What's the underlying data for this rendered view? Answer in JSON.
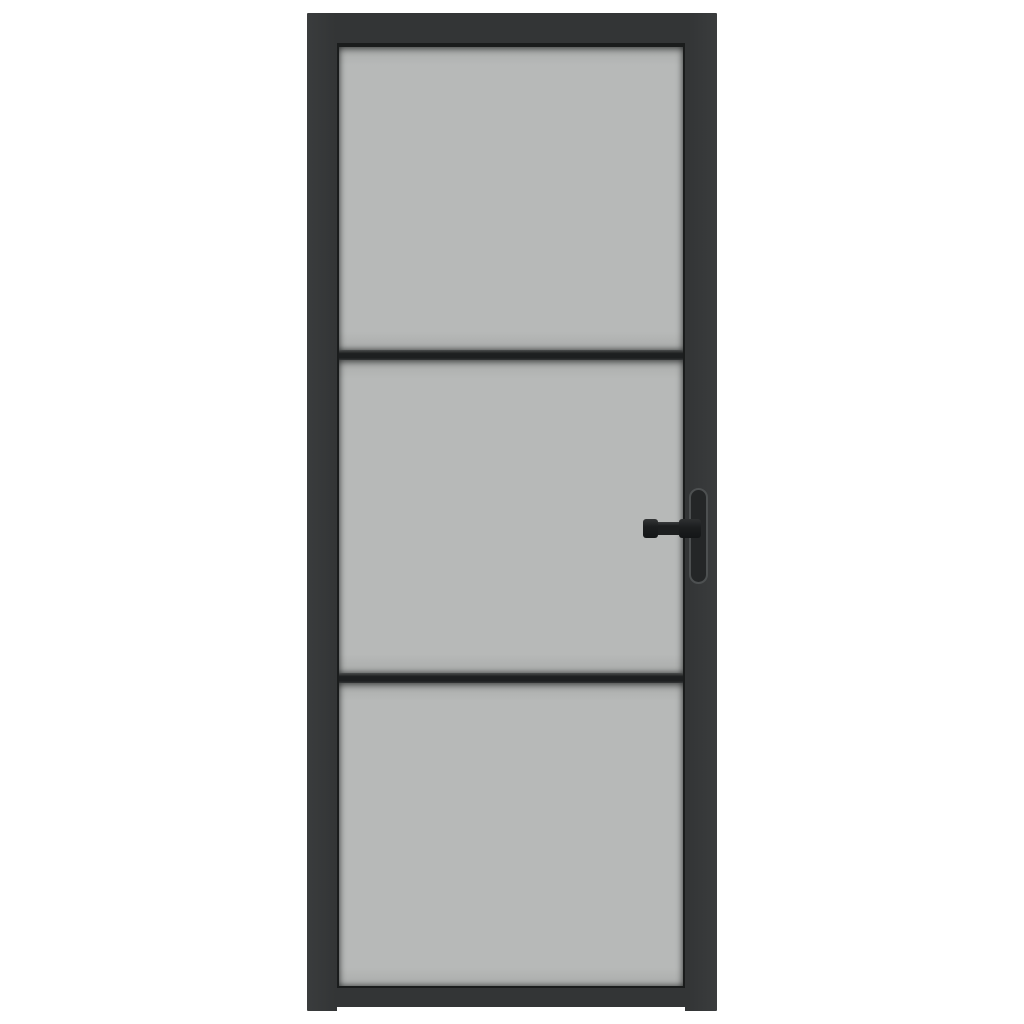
{
  "image": {
    "type": "product-photo",
    "subject": "interior door with black frame, three frosted glass panes, two horizontal glazing bars and a black lever handle on the right stile",
    "orientation": "portrait",
    "text_content": ""
  },
  "colors": {
    "background": "#ffffff",
    "frame": "#333536",
    "frame_edge": "#3a3c3d",
    "glass": "#b7b9b8",
    "glass_shade": "#aaacab",
    "glazing_shadow": "#1a1c1c",
    "bar": "#1d1f20",
    "bar_highlight": "#4a4c4c",
    "handle": "#1c1e1f",
    "handle_plate": "#242627",
    "handle_plate_outline": "#4d5051"
  },
  "door": {
    "pane_count": 3,
    "glazing_bar_count": 2,
    "handle_side": "right",
    "handle_type": "lever-with-backplate",
    "frame_style": "industrial-steel-look",
    "glass_style": "frosted"
  }
}
